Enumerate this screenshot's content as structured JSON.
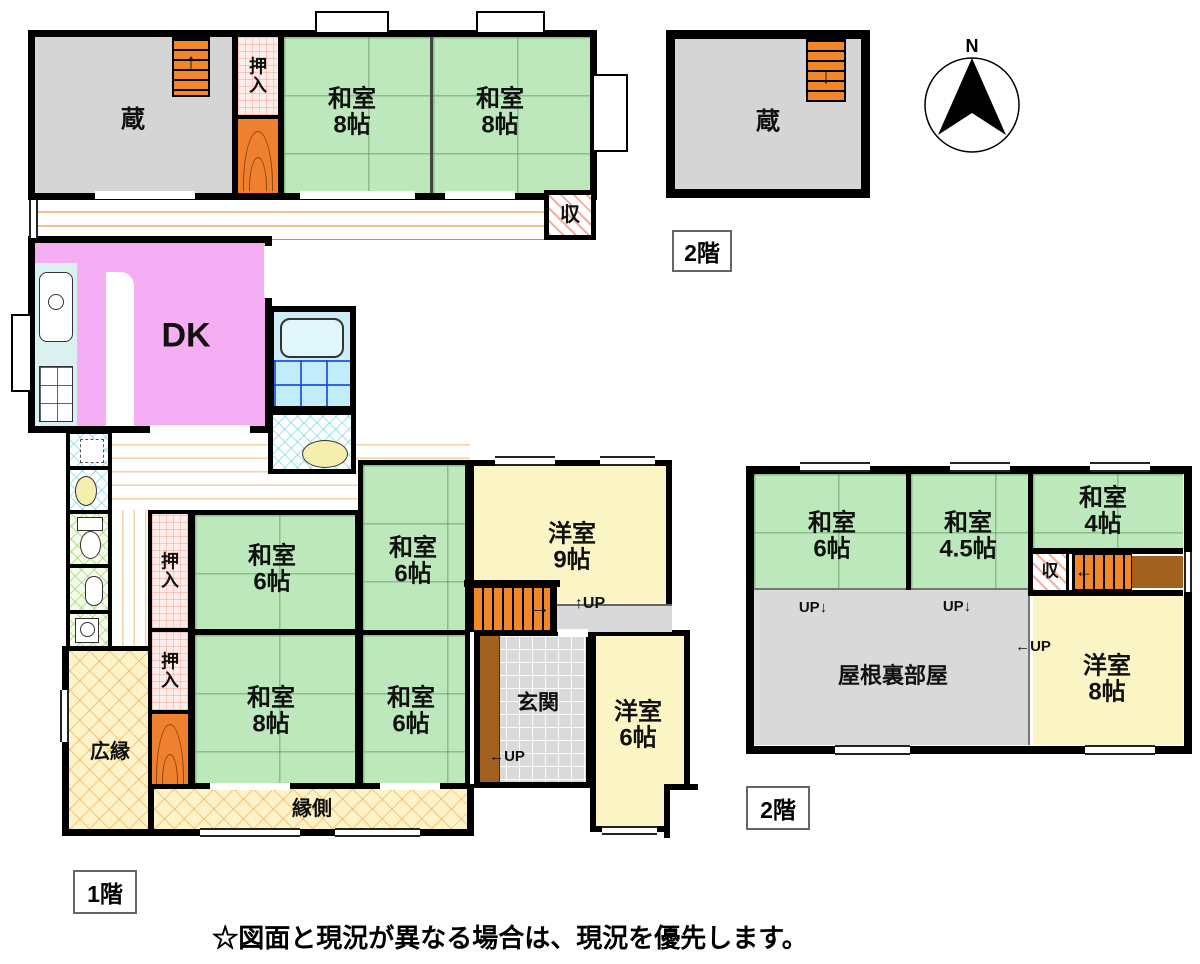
{
  "note": "☆図面と現況が異なる場合は、現況を優先します。",
  "boxes": {
    "floor1": "1階",
    "floor2_top": "2階",
    "floor2_right": "2階"
  },
  "compass": {
    "n": "N"
  },
  "arrows": {
    "up": "↑",
    "down": "↓",
    "left": "←",
    "right": "→"
  },
  "block_a": {
    "kura": "蔵",
    "oshiire": "押入",
    "w8a": {
      "name": "和室",
      "size": "8帖"
    },
    "w8b": {
      "name": "和室",
      "size": "8帖"
    },
    "shu": "収"
  },
  "dk": {
    "label": "DK"
  },
  "f1": {
    "w6a": {
      "name": "和室",
      "size": "6帖"
    },
    "w6b": {
      "name": "和室",
      "size": "6帖"
    },
    "y9": {
      "name": "洋室",
      "size": "9帖"
    },
    "oshiire1": "押入",
    "oshiire2": "押入",
    "w8": {
      "name": "和室",
      "size": "8帖"
    },
    "w6c": {
      "name": "和室",
      "size": "6帖"
    },
    "genkan": "玄関",
    "y6": {
      "name": "洋室",
      "size": "6帖"
    },
    "hiroen": "広縁",
    "engawa": "縁側",
    "up_stairs": "↑UP",
    "up_genkan": "←UP"
  },
  "f2": {
    "w6": {
      "name": "和室",
      "size": "6帖"
    },
    "w45": {
      "name": "和室",
      "size": "4.5帖"
    },
    "w4": {
      "name": "和室",
      "size": "4帖"
    },
    "shu": "収",
    "yaneura": "屋根裏部屋",
    "y8": {
      "name": "洋室",
      "size": "8帖"
    },
    "up1": "UP↓",
    "up2": "UP↓",
    "up3": "←UP"
  },
  "f2_kura": {
    "kura": "蔵"
  },
  "colors": {
    "tatami_green": "#bce8bc",
    "western_cream": "#fbf5c6",
    "dk_pink": "#f5adf3",
    "storage_gray": "#d5d5d5",
    "stair_orange": "#f18727",
    "step_brown": "#a2611f"
  }
}
